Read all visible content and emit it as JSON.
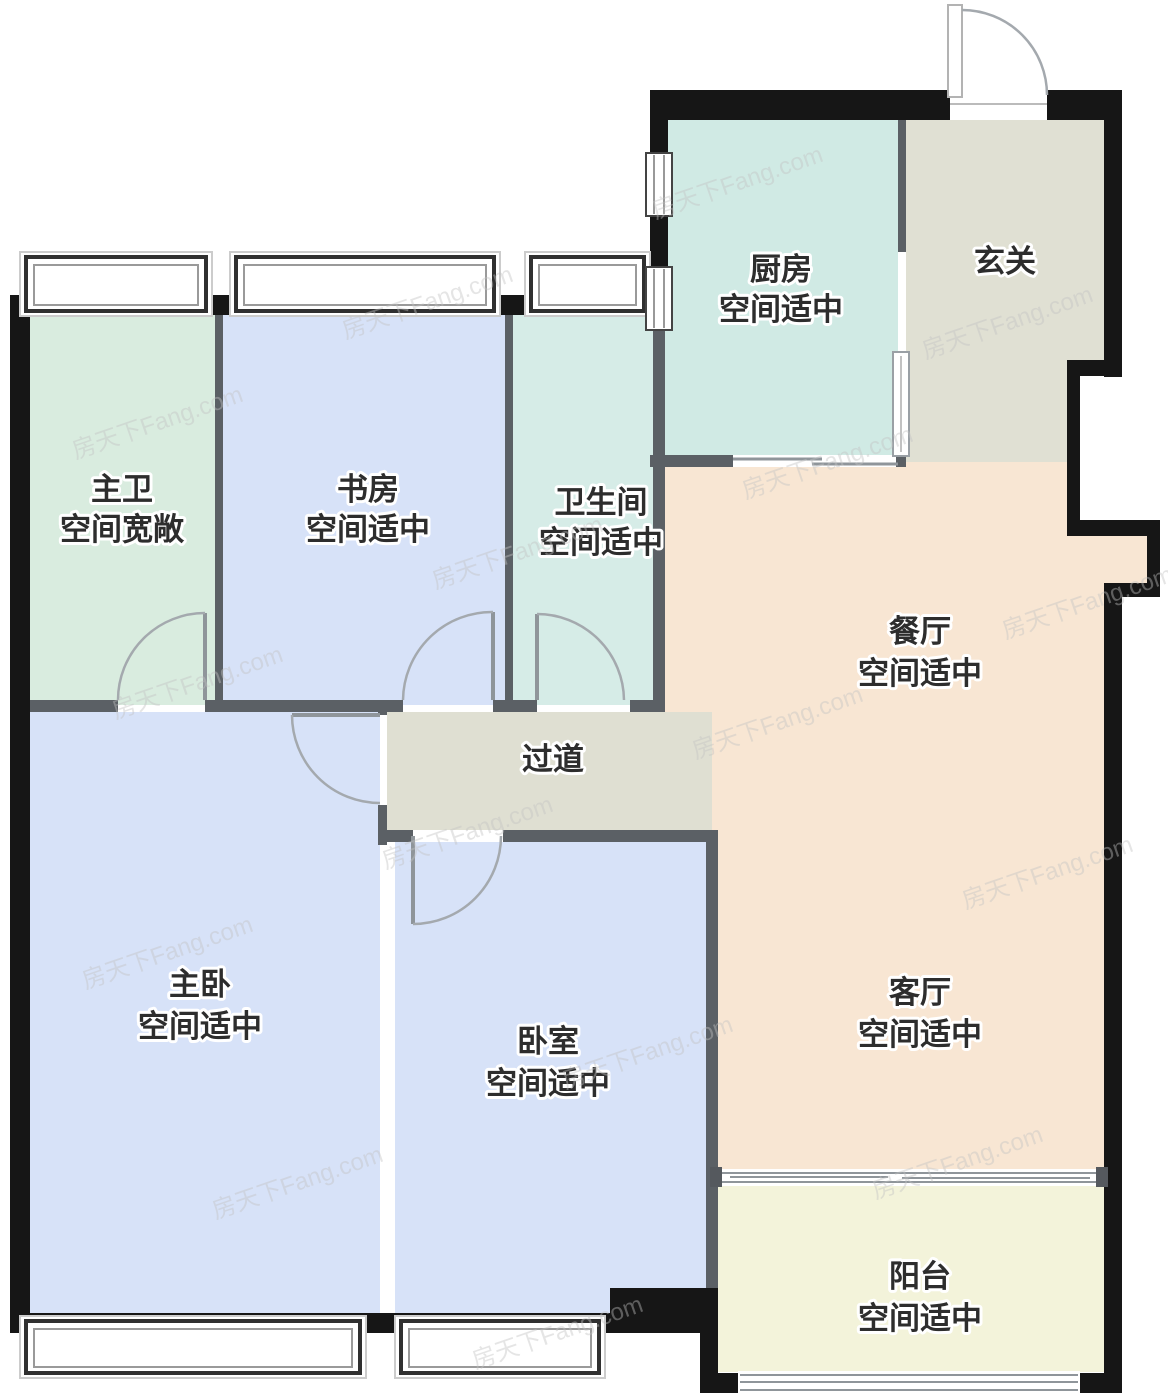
{
  "plan": {
    "watermark": "房天下Fang.com",
    "colors": {
      "wall": "#161616",
      "thin_wall": "#5b6065",
      "hall_floor": "#dfdfd2"
    },
    "rooms": [
      {
        "name": "厨房",
        "note": "空间适中",
        "color": "#d0eae4"
      },
      {
        "name": "玄关",
        "note": "",
        "color": "#e0e0d3"
      },
      {
        "name": "主卫",
        "note": "空间宽敞",
        "color": "#d9ecdf"
      },
      {
        "name": "书房",
        "note": "空间适中",
        "color": "#d7e2f8"
      },
      {
        "name": "卫生间",
        "note": "空间适中",
        "color": "#d6ece7"
      },
      {
        "name": "餐厅",
        "note": "空间适中",
        "color": "#f8e6d3"
      },
      {
        "name": "过道",
        "note": "",
        "color": "#dfdfd2"
      },
      {
        "name": "主卧",
        "note": "空间适中",
        "color": "#d7e2f8"
      },
      {
        "name": "卧室",
        "note": "空间适中",
        "color": "#d7e2f8"
      },
      {
        "name": "客厅",
        "note": "空间适中",
        "color": "#f8e6d3"
      },
      {
        "name": "阳台",
        "note": "空间适中",
        "color": "#f3f3da"
      }
    ]
  }
}
